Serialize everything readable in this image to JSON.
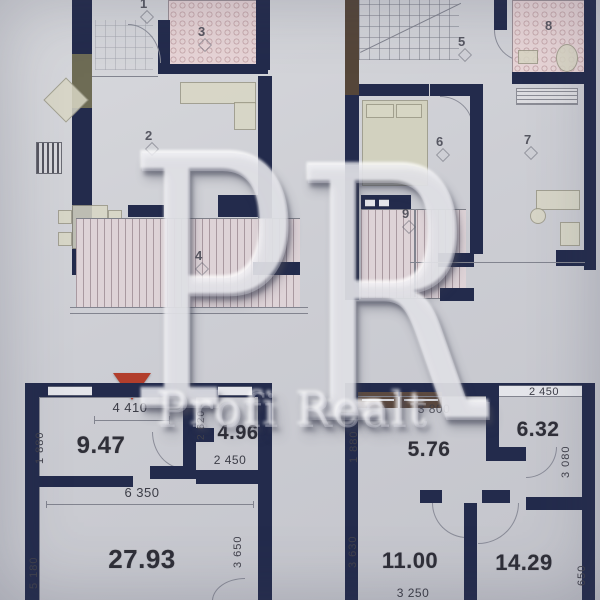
{
  "watermark": {
    "letter_p": "P",
    "letter_r": "R",
    "name": "Profi Realt"
  },
  "upper_left_plan": {
    "room_1": "1",
    "room_2": "2",
    "room_3": "3",
    "room_4": "4"
  },
  "upper_right_plan": {
    "room_5": "5",
    "room_6": "6",
    "room_7": "7",
    "room_8": "8",
    "room_9": "9"
  },
  "lower_left_plan": {
    "area_hall": "9.47",
    "area_bath": "4.96",
    "area_living": "27.93",
    "dim_top_width": "4 410",
    "dim_left_upper": "1 880",
    "dim_bath_depth": "2 620",
    "dim_bath_width": "2 450",
    "dim_living_width": "6 350",
    "dim_left_lower": "5 180",
    "dim_right_height": "3 650"
  },
  "lower_right_plan": {
    "area_hall": "5.76",
    "area_kitchen": "6.32",
    "area_room_left": "11.00",
    "area_room_right": "14.29",
    "dim_top_left_width": "3 800",
    "dim_top_right_width": "2 450",
    "dim_left_upper": "1 880",
    "dim_right_upper": "3 080",
    "dim_left_lower": "3 630",
    "dim_bottom_width": "3 250",
    "dim_right_lower": "650"
  },
  "colors": {
    "wall": "#232b4c",
    "paper": "#cdced4",
    "tile_pink": "#e7d4d6",
    "entry_marker": "#b23e2c"
  }
}
